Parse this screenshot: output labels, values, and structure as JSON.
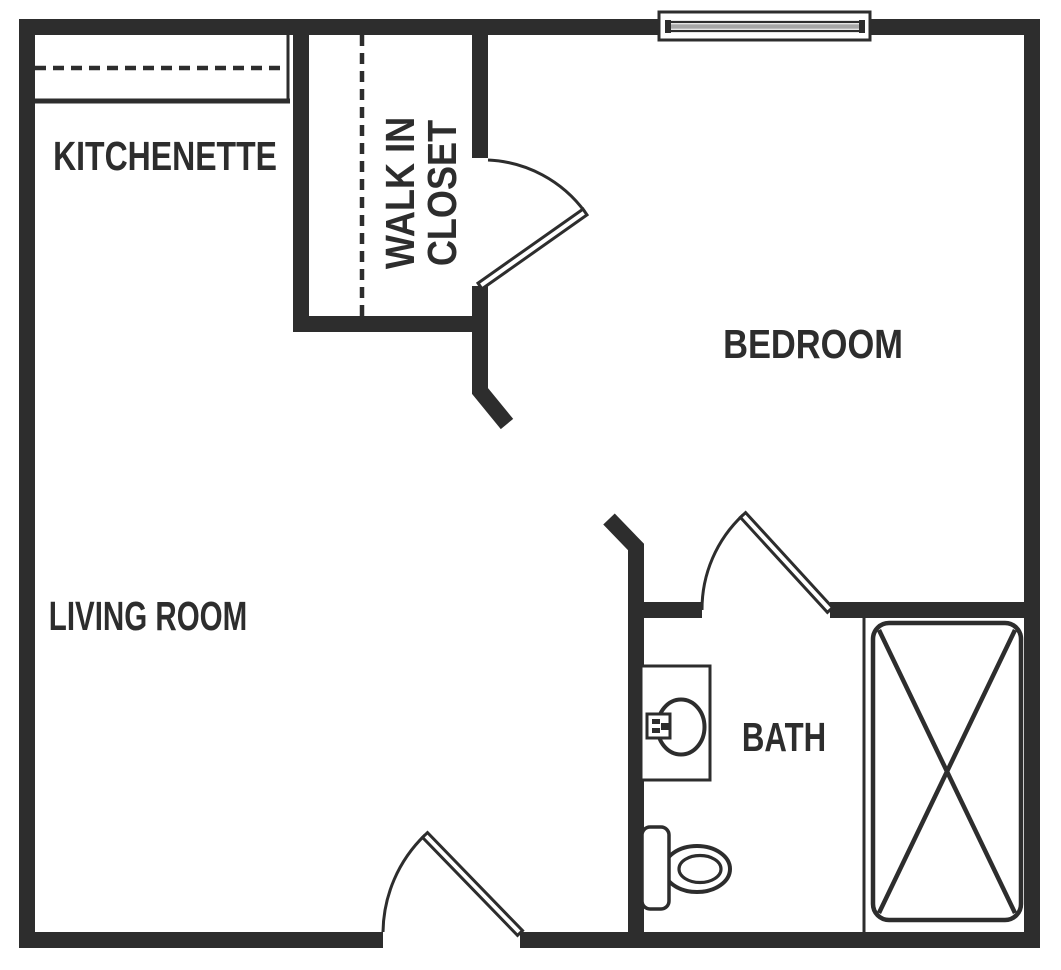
{
  "rooms": [
    {
      "id": "kitchenette",
      "label": "KITCHENETTE"
    },
    {
      "id": "walk_in_closet",
      "label": "WALK IN\nCLOSET"
    },
    {
      "id": "bedroom",
      "label": "BEDROOM"
    },
    {
      "id": "living_room",
      "label": "LIVING ROOM"
    },
    {
      "id": "bath",
      "label": "BATH"
    }
  ],
  "colors": {
    "wall": "#2d2d2d",
    "background": "#ffffff",
    "window_glass": "#a6a6a6"
  },
  "fixtures": [
    "window",
    "kitchenette-counter",
    "kitchenette-counter-dashed-line",
    "closet-dashed-line",
    "closet-door",
    "bathroom-door",
    "entry-door",
    "sink-vanity",
    "sink-bowl",
    "faucet",
    "toilet",
    "bathtub"
  ]
}
